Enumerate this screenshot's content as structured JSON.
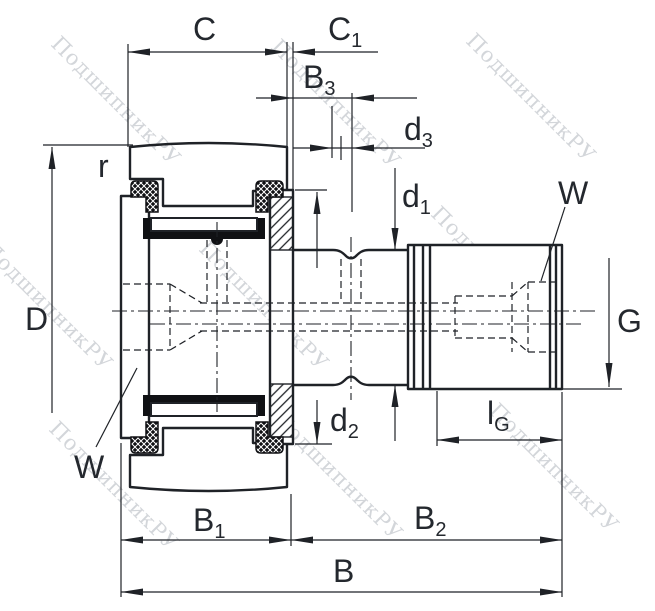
{
  "drawing": {
    "title": "stud-type track roller bearing dimension drawing",
    "watermark": {
      "text": "ПодшипникРУ",
      "color": "#a8aeb6"
    },
    "colors": {
      "line": "#1f2227",
      "label": "#24282e",
      "watermark": "#a8aeb6",
      "background": "#ffffff"
    },
    "labels": {
      "c": {
        "main": "C"
      },
      "c1": {
        "main": "C",
        "sub": "1"
      },
      "b3": {
        "main": "B",
        "sub": "3"
      },
      "d3": {
        "main": "d",
        "sub": "3"
      },
      "d1": {
        "main": "d",
        "sub": "1"
      },
      "w_right": {
        "main": "W"
      },
      "g": {
        "main": "G"
      },
      "r": {
        "main": "r"
      },
      "d_outer": {
        "main": "D"
      },
      "w_left": {
        "main": "W"
      },
      "d2": {
        "main": "d",
        "sub": "2"
      },
      "lg": {
        "main": "l",
        "sub": "G"
      },
      "b1": {
        "main": "B",
        "sub": "1"
      },
      "b2": {
        "main": "B",
        "sub": "2"
      },
      "b": {
        "main": "B"
      }
    }
  }
}
